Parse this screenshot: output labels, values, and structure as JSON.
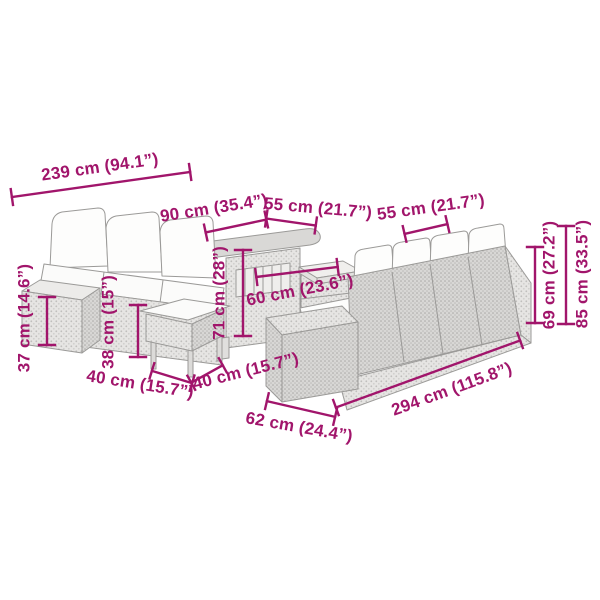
{
  "diagram": {
    "colors": {
      "background": "#ffffff",
      "dimension_accent": "#A1156B",
      "furniture_outline": "#9b9a98",
      "rattan_fill": "#e4e3e1",
      "rattan_dark_fill": "#d6d5d3",
      "cushion_fill": "#fdfdfc"
    },
    "dimensions": {
      "left_group_width": "239 cm (94.1”)",
      "table_top_width": "90 cm (35.4”)",
      "table_top_depth": "55 cm (21.7”)",
      "right_sofa_seat_depth": "55 cm (21.7”)",
      "table_shelf_width": "60 cm (23.6”)",
      "side_table_height": "37 cm (14.6”)",
      "stool_height": "38 cm (15”)",
      "table_height": "71 cm (28”)",
      "stool_width": "40 cm (15.7”)",
      "stool_depth": "40 cm (15.7”)",
      "right_sofa_depth": "62 cm (24.4”)",
      "right_sofa_width": "294 cm (115.8”)",
      "backrest_height": "69 cm (27.2”)",
      "total_height": "85 cm (33.5”)"
    }
  }
}
